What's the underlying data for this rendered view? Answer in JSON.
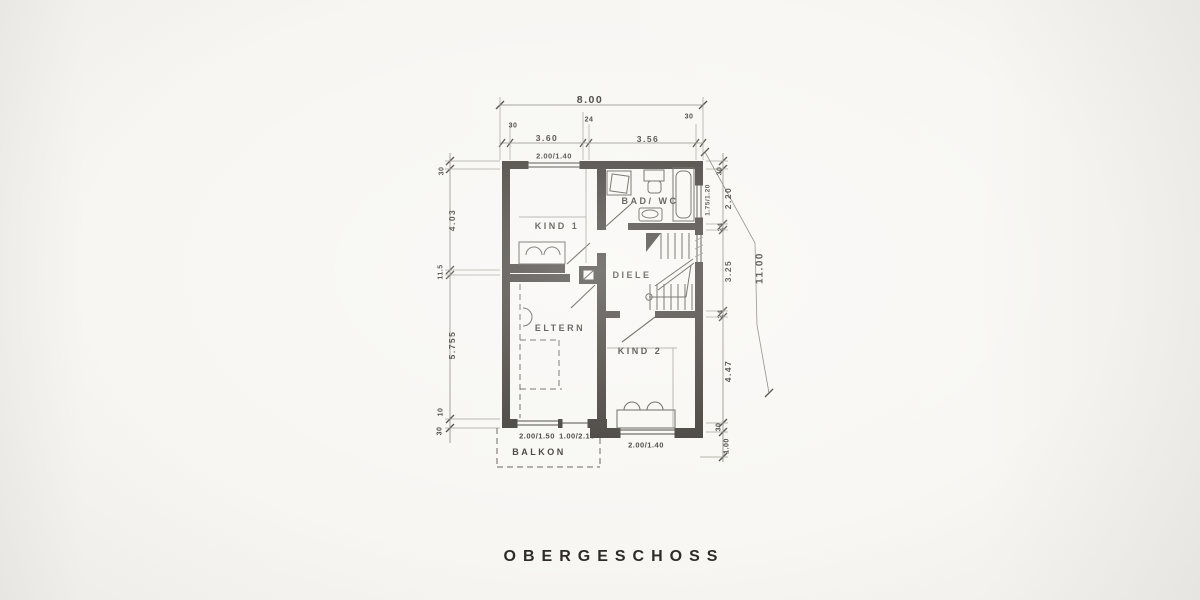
{
  "title": "OBERGESCHOSS",
  "rooms": {
    "kind1": "KIND 1",
    "bad": "BAD/ WC",
    "diele": "DIELE",
    "eltern": "ELTERN",
    "kind2": "KIND 2",
    "balkon": "BALKON"
  },
  "openings": {
    "kind1_window": "2.00/1.40",
    "bad_window": "1.75/1.20",
    "eltern_window": "2.00/1.50",
    "balkon_door": "1.00/2.10",
    "kind2_window": "2.00/1.40"
  },
  "dims": {
    "top": {
      "overall": "8.00",
      "wl": "30",
      "a": "3.60",
      "m": "24",
      "b": "3.56",
      "wr": "30"
    },
    "left": {
      "wt": "30",
      "a": "4.03",
      "m": "11.5",
      "b": "5.755",
      "c": "10",
      "wb": "30"
    },
    "right": {
      "wt": "30",
      "a": "2.20",
      "m1": "24",
      "b": "3.25",
      "m2": "24",
      "c": "4.47",
      "wb": "30",
      "d": "1.00",
      "overall": "11.00"
    }
  },
  "colors": {
    "ink": "#36322d",
    "paper": "#f8f7f4"
  }
}
